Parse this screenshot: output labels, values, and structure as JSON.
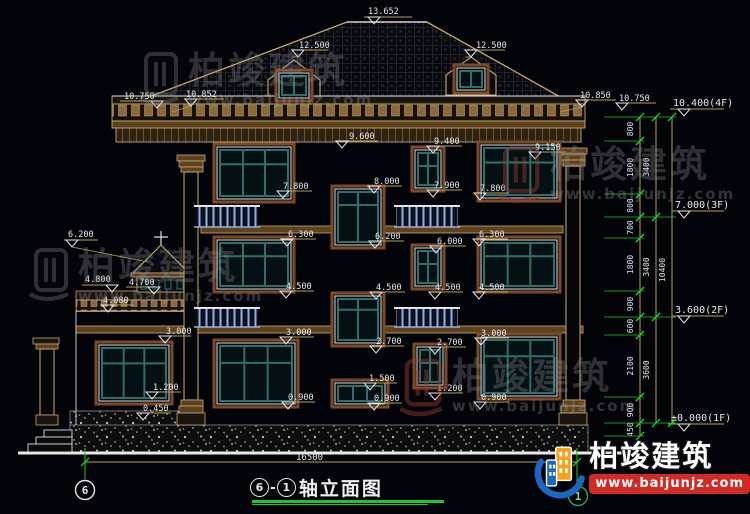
{
  "title_block": {
    "axis_start": "6",
    "separator": "-",
    "axis_end": "1",
    "title": "轴立面图"
  },
  "axis_bubbles": {
    "left": "6",
    "right": "1"
  },
  "ground_dimension": "16500",
  "brand": {
    "name": "柏竣建筑",
    "url": "www.baijunjz.com"
  },
  "watermarks": [
    {
      "text": "柏竣建筑",
      "url": "www.baijunjz.com"
    },
    {
      "text": "柏竣建筑",
      "url": "www.baijunjz.com"
    },
    {
      "text": "柏竣建筑",
      "url": "www.baijunjz.com"
    },
    {
      "text": "柏竣建筑",
      "url": "www.baijunjz.com"
    }
  ],
  "colors": {
    "background": "#030409",
    "line_white": "#e0e4e8",
    "cad_tan": "#c9a96b",
    "dim_yellow": "#b5a24e",
    "cad_green": "#19c82e",
    "window_teal": "#2f6f6d",
    "surround_brown": "#7c4a28",
    "band_brown": "#5d4220",
    "railing_blue": "#9ab0d8",
    "banner_red": "#d22a24",
    "logo_orange": "#f7a21b",
    "logo_blue": "#1c67c2"
  },
  "annotations": {
    "elevation_markers": [
      {
        "text": "13.652",
        "x": 368,
        "y": 14,
        "ux1": 364,
        "ux2": 412,
        "uy": 17,
        "tx": 374,
        "lead": [
          374,
          22
        ]
      },
      {
        "text": "12.500",
        "x": 299,
        "y": 48,
        "ux1": 292,
        "ux2": 328,
        "uy": 50,
        "tx": 298,
        "lead": [
          292,
          57
        ]
      },
      {
        "text": "12.500",
        "x": 476,
        "y": 48,
        "ux1": 466,
        "ux2": 505,
        "uy": 50,
        "tx": 471,
        "lead": [
          465,
          57
        ]
      },
      {
        "text": "10.750",
        "x": 124,
        "y": 99,
        "ux1": 120,
        "ux2": 163,
        "uy": 101,
        "tx": 157
      },
      {
        "text": "10.852",
        "x": 186,
        "y": 97,
        "ux1": 184,
        "ux2": 224,
        "uy": 99,
        "tx": 191,
        "lead": [
          172,
          112
        ]
      },
      {
        "text": "10.850",
        "x": 580,
        "y": 98,
        "ux1": 576,
        "ux2": 616,
        "uy": 100,
        "tx": 582,
        "lead": [
          560,
          112
        ]
      },
      {
        "text": "10.750",
        "x": 619,
        "y": 101,
        "ux1": 616,
        "ux2": 656,
        "uy": 103,
        "tx": 622
      },
      {
        "text": "9.600",
        "x": 349,
        "y": 139,
        "ux1": 344,
        "ux2": 378,
        "uy": 141,
        "tx": 342
      },
      {
        "text": "9.400",
        "x": 434,
        "y": 144,
        "ux1": 430,
        "ux2": 462,
        "uy": 146,
        "tx": 433
      },
      {
        "text": "9.150",
        "x": 535,
        "y": 150,
        "ux1": 531,
        "ux2": 566,
        "uy": 152,
        "tx": 535
      },
      {
        "text": "8.000",
        "x": 374,
        "y": 184,
        "ux1": 370,
        "ux2": 402,
        "uy": 186,
        "tx": 374
      },
      {
        "text": "7.800",
        "x": 283,
        "y": 189,
        "ux1": 279,
        "ux2": 312,
        "uy": 191,
        "tx": 283
      },
      {
        "text": "7.900",
        "x": 434,
        "y": 188,
        "ux1": 430,
        "ux2": 462,
        "uy": 190,
        "tx": 433
      },
      {
        "text": "7.800",
        "x": 480,
        "y": 191,
        "ux1": 476,
        "ux2": 509,
        "uy": 193,
        "tx": 480
      },
      {
        "text": "6.300",
        "x": 288,
        "y": 237,
        "ux1": 284,
        "ux2": 316,
        "uy": 239,
        "tx": 287
      },
      {
        "text": "6.200",
        "x": 375,
        "y": 239,
        "ux1": 371,
        "ux2": 404,
        "uy": 241,
        "tx": 375
      },
      {
        "text": "6.000",
        "x": 437,
        "y": 244,
        "ux1": 433,
        "ux2": 466,
        "uy": 246,
        "tx": 436
      },
      {
        "text": "6.300",
        "x": 479,
        "y": 237,
        "ux1": 475,
        "ux2": 508,
        "uy": 239,
        "tx": 479
      },
      {
        "text": "6.200",
        "x": 68,
        "y": 237,
        "ux1": 64,
        "ux2": 98,
        "uy": 240,
        "tx": 72,
        "lead": [
          148,
          262
        ]
      },
      {
        "text": "4.800",
        "x": 85,
        "y": 282,
        "ux1": 82,
        "ux2": 116,
        "uy": 285,
        "tx": 112
      },
      {
        "text": "4.700",
        "x": 129,
        "y": 285,
        "ux1": 126,
        "ux2": 158,
        "uy": 287,
        "tx": 154
      },
      {
        "text": "4.080",
        "x": 103,
        "y": 303,
        "ux1": 100,
        "ux2": 134,
        "uy": 305,
        "tx": 108
      },
      {
        "text": "4.500",
        "x": 286,
        "y": 289,
        "ux1": 282,
        "ux2": 314,
        "uy": 291,
        "tx": 286
      },
      {
        "text": "4.500",
        "x": 376,
        "y": 290,
        "ux1": 372,
        "ux2": 405,
        "uy": 292,
        "tx": 376
      },
      {
        "text": "4.500",
        "x": 435,
        "y": 290,
        "ux1": 431,
        "ux2": 463,
        "uy": 292,
        "tx": 435
      },
      {
        "text": "4.500",
        "x": 479,
        "y": 290,
        "ux1": 475,
        "ux2": 508,
        "uy": 292,
        "tx": 479
      },
      {
        "text": "3.000",
        "x": 166,
        "y": 334,
        "ux1": 161,
        "ux2": 191,
        "uy": 336,
        "tx": 165
      },
      {
        "text": "3.000",
        "x": 286,
        "y": 335,
        "ux1": 282,
        "ux2": 314,
        "uy": 337,
        "tx": 286
      },
      {
        "text": "3.000",
        "x": 481,
        "y": 336,
        "ux1": 477,
        "ux2": 509,
        "uy": 338,
        "tx": 481
      },
      {
        "text": "2.700",
        "x": 376,
        "y": 344,
        "ux1": 372,
        "ux2": 404,
        "uy": 346,
        "tx": 376
      },
      {
        "text": "2.700",
        "x": 437,
        "y": 345,
        "ux1": 431,
        "ux2": 466,
        "uy": 347,
        "tx": 435
      },
      {
        "text": "1.500",
        "x": 369,
        "y": 381,
        "ux1": 365,
        "ux2": 397,
        "uy": 383,
        "tx": 370
      },
      {
        "text": "1.200",
        "x": 153,
        "y": 390,
        "ux1": 149,
        "ux2": 181,
        "uy": 392,
        "tx": 152
      },
      {
        "text": "1.200",
        "x": 437,
        "y": 391,
        "ux1": 431,
        "ux2": 463,
        "uy": 393,
        "tx": 435
      },
      {
        "text": "0.900",
        "x": 288,
        "y": 400,
        "ux1": 283,
        "ux2": 315,
        "uy": 402,
        "tx": 288
      },
      {
        "text": "0.900",
        "x": 374,
        "y": 401,
        "ux1": 370,
        "ux2": 402,
        "uy": 403,
        "tx": 374
      },
      {
        "text": "0.900",
        "x": 481,
        "y": 400,
        "ux1": 476,
        "ux2": 509,
        "uy": 402,
        "tx": 480
      },
      {
        "text": "0.450",
        "x": 143,
        "y": 411,
        "ux1": 139,
        "ux2": 171,
        "uy": 413,
        "tx": 143
      },
      {
        "text": "10.400(4F)",
        "x": 673,
        "y": 106,
        "ux1": 670,
        "ux2": 724,
        "uy": 109,
        "tx": 684,
        "cls": "floor"
      },
      {
        "text": "7.000(3F)",
        "x": 675,
        "y": 208,
        "ux1": 672,
        "ux2": 724,
        "uy": 211,
        "tx": 684,
        "cls": "floor"
      },
      {
        "text": "3.600(2F)",
        "x": 675,
        "y": 313,
        "ux1": 672,
        "ux2": 724,
        "uy": 316,
        "tx": 684,
        "cls": "floor"
      },
      {
        "text": "±0.000(1F)",
        "x": 671,
        "y": 421,
        "ux1": 668,
        "ux2": 724,
        "uy": 424,
        "tx": 684,
        "cls": "floor"
      }
    ],
    "right_chain": {
      "segments": [
        {
          "v": "800",
          "y1": 117,
          "y2": 141
        },
        {
          "v": "1800",
          "y1": 141,
          "y2": 194
        },
        {
          "v": "800",
          "y1": 194,
          "y2": 217
        },
        {
          "v": "700",
          "y1": 217,
          "y2": 238
        },
        {
          "v": "1800",
          "y1": 238,
          "y2": 291
        },
        {
          "v": "900",
          "y1": 291,
          "y2": 317
        },
        {
          "v": "600",
          "y1": 317,
          "y2": 335
        },
        {
          "v": "2100",
          "y1": 335,
          "y2": 397
        },
        {
          "v": "900",
          "y1": 397,
          "y2": 423
        },
        {
          "v": "450",
          "y1": 423,
          "y2": 436
        }
      ],
      "groups": [
        {
          "v": "3400",
          "y1": 117,
          "y2": 217
        },
        {
          "v": "3400",
          "y1": 217,
          "y2": 317
        },
        {
          "v": "3600",
          "y1": 317,
          "y2": 423
        }
      ],
      "total": {
        "v": "10400",
        "y1": 117,
        "y2": 423
      },
      "major_levels": [
        117,
        217,
        317,
        423
      ],
      "minor_levels": [
        141,
        194,
        238,
        291,
        335,
        397,
        436
      ]
    }
  },
  "drawing": {
    "windows": [
      {
        "x": 214,
        "y": 144,
        "w": 80,
        "h": 58,
        "t": "big3"
      },
      {
        "x": 478,
        "y": 142,
        "w": 82,
        "h": 59,
        "t": "big3"
      },
      {
        "x": 412,
        "y": 147,
        "w": 32,
        "h": 44,
        "t": "small"
      },
      {
        "x": 332,
        "y": 186,
        "w": 52,
        "h": 62,
        "t": "stair"
      },
      {
        "x": 214,
        "y": 237,
        "w": 80,
        "h": 55,
        "t": "big3"
      },
      {
        "x": 478,
        "y": 237,
        "w": 82,
        "h": 55,
        "t": "big3"
      },
      {
        "x": 412,
        "y": 245,
        "w": 32,
        "h": 44,
        "t": "small"
      },
      {
        "x": 332,
        "y": 293,
        "w": 52,
        "h": 53,
        "t": "stair"
      },
      {
        "x": 214,
        "y": 340,
        "w": 84,
        "h": 67,
        "t": "big3"
      },
      {
        "x": 478,
        "y": 334,
        "w": 82,
        "h": 65,
        "t": "big3"
      },
      {
        "x": 332,
        "y": 380,
        "w": 56,
        "h": 27,
        "t": "widelow"
      },
      {
        "x": 414,
        "y": 344,
        "w": 32,
        "h": 44,
        "t": "small"
      },
      {
        "x": 96,
        "y": 342,
        "w": 76,
        "h": 62,
        "t": "big3"
      },
      {
        "x": 276,
        "y": 70,
        "w": 36,
        "h": 31,
        "t": "dormer"
      },
      {
        "x": 454,
        "y": 65,
        "w": 34,
        "h": 28,
        "t": "dormer"
      }
    ],
    "railings": [
      {
        "x": 196,
        "y": 204,
        "w": 62,
        "h": 23
      },
      {
        "x": 396,
        "y": 204,
        "w": 62,
        "h": 23
      },
      {
        "x": 196,
        "y": 306,
        "w": 62,
        "h": 21
      },
      {
        "x": 396,
        "y": 306,
        "w": 62,
        "h": 21
      }
    ]
  }
}
